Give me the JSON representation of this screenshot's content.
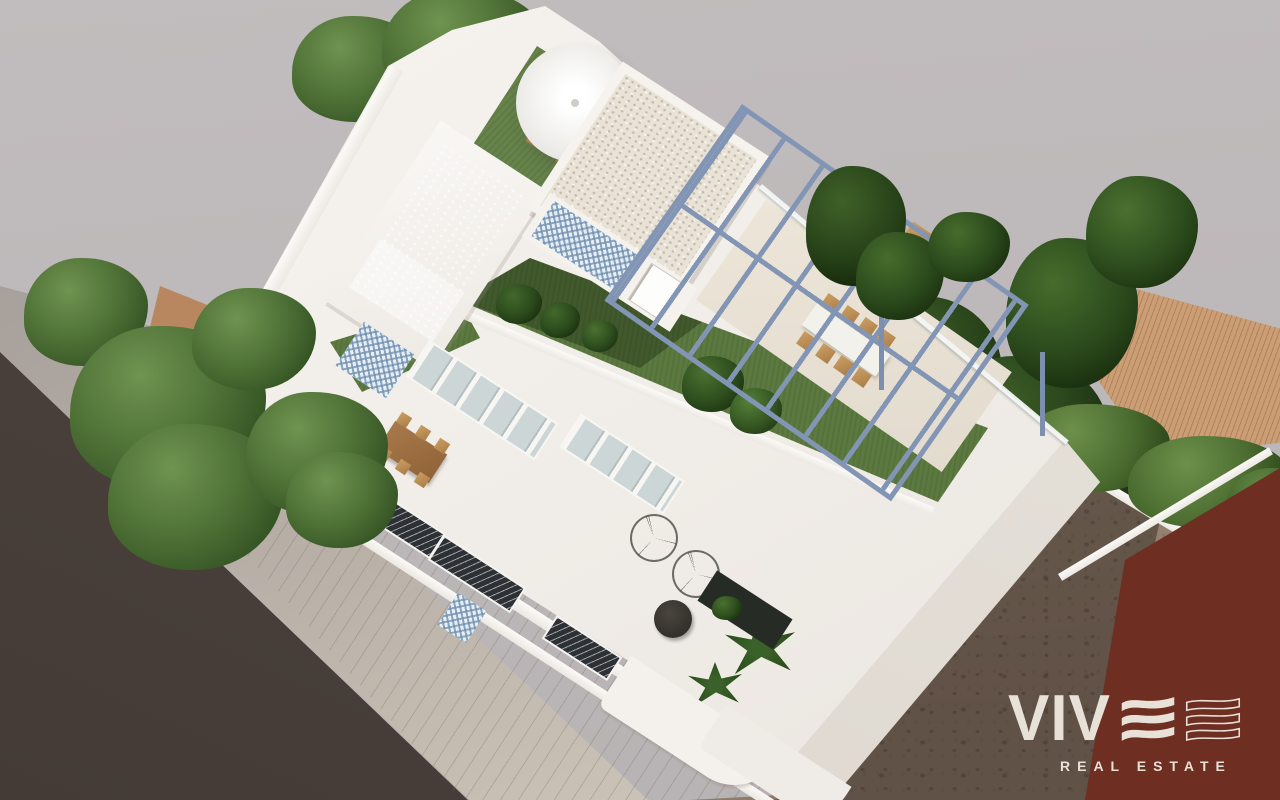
{
  "watermark": {
    "brand_text": "VIV",
    "tagline": "REAL ESTATE",
    "color": "#e8e1d8",
    "icons": {
      "filled": "wave-e-icon",
      "outline": "wave-e-outline-icon"
    }
  },
  "scene": {
    "type": "3d-architectural-render",
    "subject": "Aerial view of a modern white villa with rooftop pool, roof garden, blue steel pergola terrace, street with sidewalk, neighbouring tiled roofs, vacant dirt lot and red corner building"
  },
  "palette": {
    "backdrop": "#bcb7b8",
    "road": "#4b423d",
    "sidewalk": "#a8a19c",
    "villa_white": "#f2efeb",
    "pool_water": "#9acaca",
    "turf_green": "#5c7a40",
    "pergola_steel": "#8395b5",
    "tile_roof": "#bc8a64",
    "dirt_lot": "#8f7b6b",
    "red_building": "#7e3526",
    "mosaic_blue": "#7fa3c2"
  }
}
